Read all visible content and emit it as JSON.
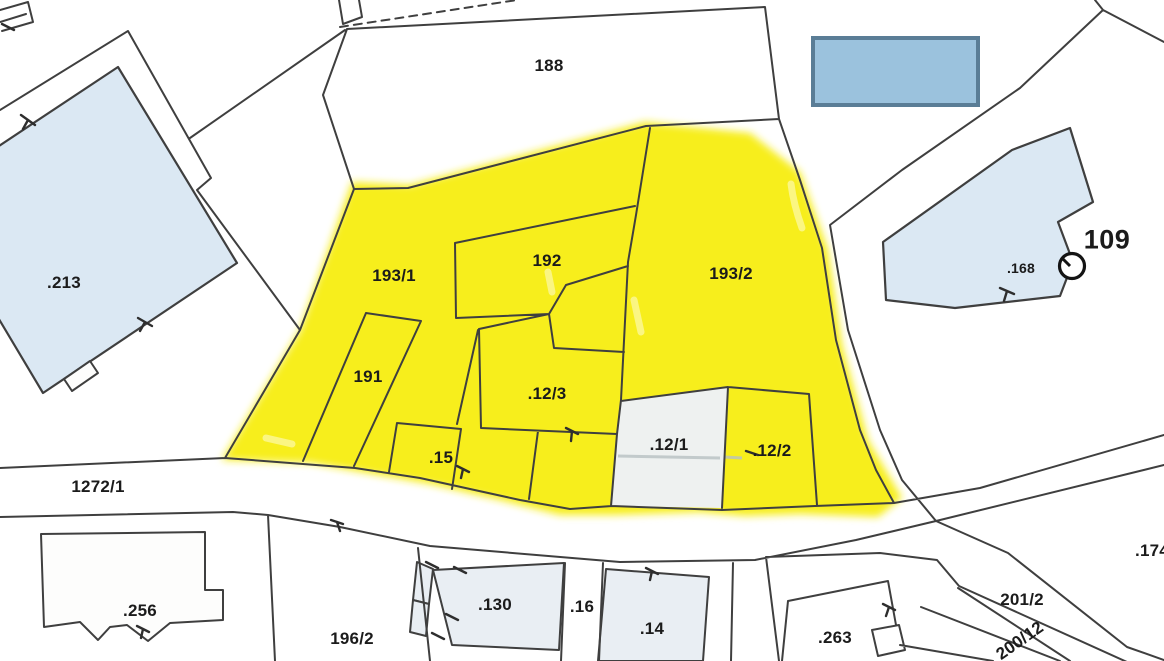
{
  "labels": [
    {
      "id": "188",
      "text": "188"
    },
    {
      "id": "193-1",
      "text": "193/1"
    },
    {
      "id": "192",
      "text": "192"
    },
    {
      "id": "193-2",
      "text": "193/2"
    },
    {
      "id": "191",
      "text": "191"
    },
    {
      "id": "12-3",
      "text": ".12/3"
    },
    {
      "id": "15",
      "text": ".15"
    },
    {
      "id": "12-1",
      "text": ".12/1"
    },
    {
      "id": "12-2",
      "text": ".12/2"
    },
    {
      "id": "213",
      "text": ".213"
    },
    {
      "id": "168",
      "text": ".168"
    },
    {
      "id": "109",
      "text": "109"
    },
    {
      "id": "1272-1",
      "text": "1272/1"
    },
    {
      "id": "256",
      "text": ".256"
    },
    {
      "id": "196-2",
      "text": "196/2"
    },
    {
      "id": "130",
      "text": ".130"
    },
    {
      "id": "16",
      "text": ".16"
    },
    {
      "id": "14",
      "text": ".14"
    },
    {
      "id": "263",
      "text": ".263"
    },
    {
      "id": "201-2",
      "text": "201/2"
    },
    {
      "id": "200-12",
      "text": "200/12"
    },
    {
      "id": "174",
      "text": ".174"
    }
  ],
  "highlight": {
    "color": "#f7ee1b",
    "parcels": [
      "193/1",
      "192",
      "193/2",
      "191",
      ".12/3",
      ".15",
      ".12/2"
    ]
  },
  "colors": {
    "highlight": "#f7ee1b",
    "boundary_line": "#3f3f3f",
    "building_fill": "#dbe8f3",
    "building_fill_light": "#e9eef3",
    "marker_fill": "#9bc2dd",
    "marker_border": "#5a7d96",
    "label_text": "#1b1b1b"
  }
}
